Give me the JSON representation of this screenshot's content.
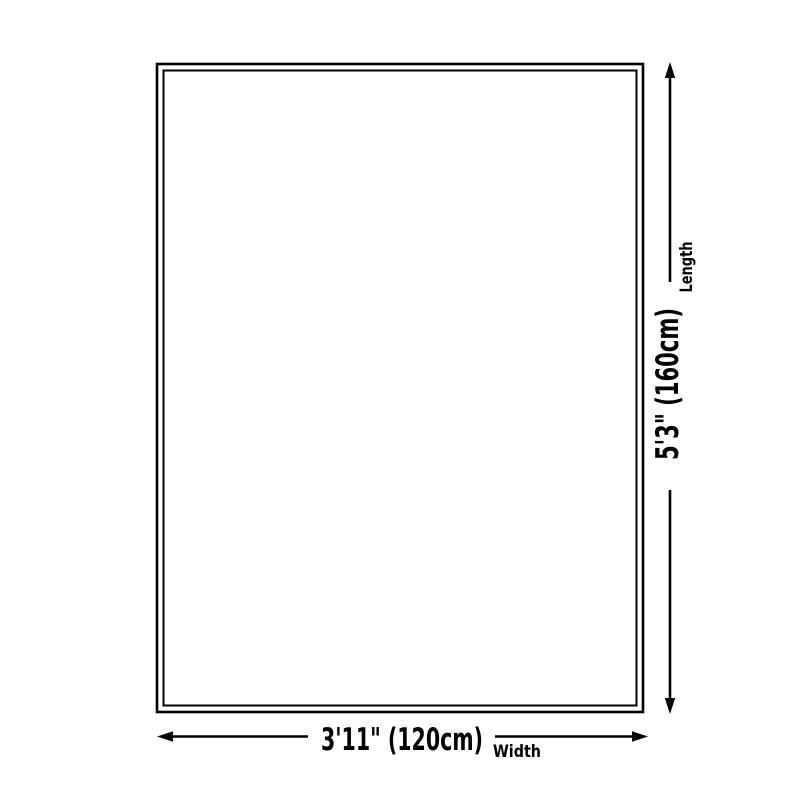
{
  "diagram": {
    "type": "product-size-diagram",
    "background_color": "#ffffff",
    "line_color": "#000000",
    "shape": {
      "kind": "rectangle",
      "border_style": "double"
    },
    "length": {
      "value": "5'3\" (160cm)",
      "label": "Length",
      "orientation": "vertical"
    },
    "width": {
      "value": "3'11\" (120cm)",
      "label": "Width",
      "orientation": "horizontal"
    }
  }
}
